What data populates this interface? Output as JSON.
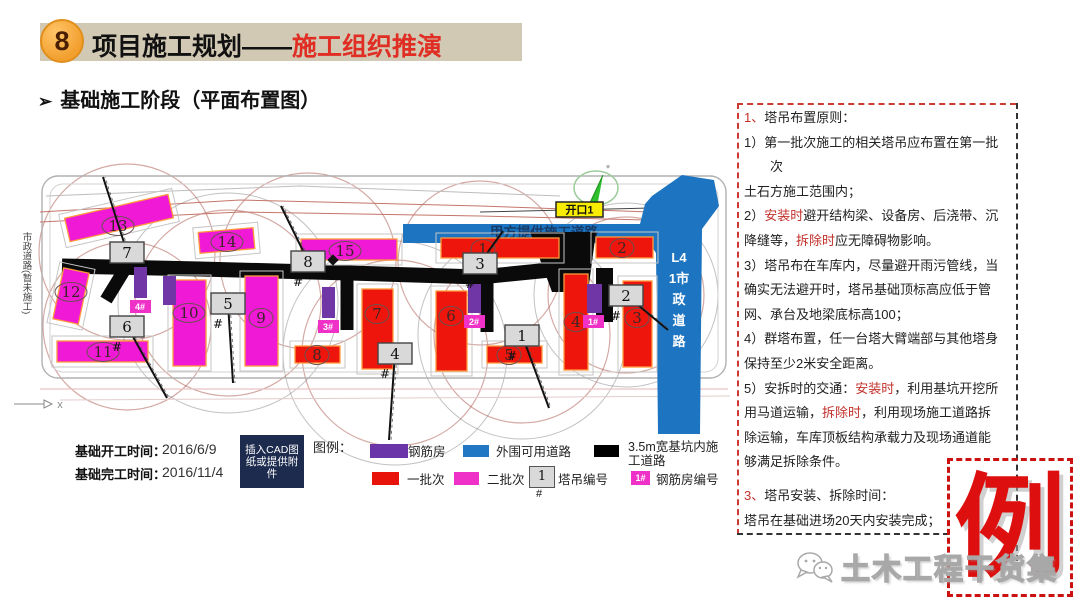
{
  "header": {
    "number": "8",
    "title_black": "项目施工规划——",
    "title_red": "施工组织推演"
  },
  "subtitle": {
    "bullet": "➢",
    "text": "基础施工阶段（平面布置图）"
  },
  "panel": {
    "lines": [
      {
        "seg": [
          {
            "t": "1、",
            "red": true
          },
          {
            "t": "塔吊布置原则：",
            "red": false
          }
        ]
      },
      {
        "seg": [
          {
            "t": "1）第一批次施工的相关塔吊应布置在第一批",
            "red": false
          }
        ]
      },
      {
        "seg": [
          {
            "t": "　　次",
            "red": false
          }
        ]
      },
      {
        "seg": [
          {
            "t": "土石方施工范围内；",
            "red": false
          }
        ]
      },
      {
        "seg": [
          {
            "t": "2）",
            "red": false
          },
          {
            "t": "安装时",
            "red": true
          },
          {
            "t": "避开结构梁、设备房、后浇带、沉",
            "red": false
          }
        ]
      },
      {
        "seg": [
          {
            "t": "降缝等，",
            "red": false
          },
          {
            "t": "拆除时",
            "red": true
          },
          {
            "t": "应无障碍物影响。",
            "red": false
          }
        ]
      },
      {
        "seg": [
          {
            "t": "3）塔吊布在车库内，尽量避开雨污管线，当",
            "red": false
          }
        ]
      },
      {
        "seg": [
          {
            "t": "确实无法避开时，塔吊基础顶标高应低于管",
            "red": false
          }
        ]
      },
      {
        "seg": [
          {
            "t": "网、承台及地梁底标高100；",
            "red": false
          }
        ]
      },
      {
        "seg": [
          {
            "t": "4）群塔布置，任一台塔大臂端部与其他塔身",
            "red": false
          }
        ]
      },
      {
        "seg": [
          {
            "t": "保持至少2米安全距离。",
            "red": false
          }
        ]
      },
      {
        "seg": [
          {
            "t": "5）安拆时的交通：",
            "red": false
          },
          {
            "t": "安装时",
            "red": true
          },
          {
            "t": "，利用基坑开挖所",
            "red": false
          }
        ]
      },
      {
        "seg": [
          {
            "t": "用马道运输，",
            "red": false
          },
          {
            "t": "拆除时",
            "red": true
          },
          {
            "t": "，利用现场施工道路拆",
            "red": false
          }
        ]
      },
      {
        "seg": [
          {
            "t": "除运输，车库顶板结构承载力及现场通道能",
            "red": false
          }
        ]
      },
      {
        "seg": [
          {
            "t": "够满足拆除条件。",
            "red": false
          }
        ]
      },
      {
        "gap": true,
        "seg": [
          {
            "t": "3、",
            "red": true
          },
          {
            "t": "塔吊安装、拆除时间：",
            "red": false
          }
        ]
      },
      {
        "seg": [
          {
            "t": "塔吊在基础进场20天内安装完成；",
            "red": false
          }
        ]
      }
    ]
  },
  "stamp": "例",
  "watermark": "土木工程干货集",
  "dates": {
    "start_label": "基础开工时间：",
    "start_value": "2016/6/9",
    "end_label": "基础完工时间：",
    "end_value": "2016/11/4"
  },
  "legend": {
    "title": "图例：",
    "cad_box": "插入CAD图纸或提供附件",
    "items_row1": [
      {
        "color": "#6a35a8",
        "label": "钢筋房"
      },
      {
        "color": "#2277c4",
        "label": "外围可用道路"
      },
      {
        "color": "#000000",
        "label": "3.5m宽基坑内施工道路"
      }
    ],
    "items_row2": [
      {
        "color": "#e8140c",
        "label": "一批次"
      },
      {
        "color": "#f031c8",
        "label": "二批次"
      }
    ],
    "crane_key": {
      "num": "1",
      "hash": "#",
      "label": "塔吊编号"
    },
    "rebar_key": {
      "num": "1#",
      "label": "钢筋房编号"
    }
  },
  "plan": {
    "side_road_label": "市政道路(暂未施工)",
    "axis_label": "x",
    "opening_label": "开口1",
    "top_road_label": "甲方提供施工道路",
    "right_road_chars": [
      "L4",
      "1市",
      "政",
      "道",
      "路"
    ],
    "colors": {
      "red": "#ee150c",
      "magenta": "#f019d6",
      "purple": "#7136a6",
      "blue": "#1d74c0",
      "road": "#0a0a0a",
      "crane_box": "#d9d9d9"
    },
    "buildings": [
      {
        "batch": "red",
        "n": "1",
        "x": 441,
        "y": 238,
        "w": 118,
        "h": 20,
        "cx": 483,
        "cy": 249
      },
      {
        "batch": "red",
        "n": "2",
        "x": 596,
        "y": 237,
        "w": 57,
        "h": 21,
        "cx": 622,
        "cy": 248
      },
      {
        "batch": "red",
        "n": "7",
        "x": 362,
        "y": 289,
        "w": 31,
        "h": 80,
        "cx": 377,
        "cy": 314
      },
      {
        "batch": "red",
        "n": "6",
        "x": 436,
        "y": 291,
        "w": 31,
        "h": 80,
        "cx": 451,
        "cy": 316
      },
      {
        "batch": "red",
        "n": "4",
        "x": 564,
        "y": 274,
        "w": 24,
        "h": 96,
        "cx": 576,
        "cy": 322
      },
      {
        "batch": "red",
        "n": "3",
        "x": 623,
        "y": 281,
        "w": 29,
        "h": 86,
        "cx": 637,
        "cy": 318
      },
      {
        "batch": "red",
        "n": "8",
        "x": 295,
        "y": 346,
        "w": 45,
        "h": 17,
        "cx": 317,
        "cy": 355
      },
      {
        "batch": "red",
        "n": "5",
        "x": 487,
        "y": 346,
        "w": 55,
        "h": 17,
        "cx": 509,
        "cy": 355
      },
      {
        "batch": "magenta",
        "n": "13",
        "x": 66,
        "y": 206,
        "w": 106,
        "h": 24,
        "rot": -13,
        "cx": 118,
        "cy": 226
      },
      {
        "batch": "magenta",
        "n": "14",
        "x": 199,
        "y": 230,
        "w": 55,
        "h": 21,
        "rot": -5,
        "cx": 227,
        "cy": 242
      },
      {
        "batch": "magenta",
        "n": "15",
        "x": 301,
        "y": 239,
        "w": 96,
        "h": 21,
        "cx": 345,
        "cy": 251
      },
      {
        "batch": "magenta",
        "n": "12",
        "x": 58,
        "y": 270,
        "w": 26,
        "h": 52,
        "rot": 12,
        "cx": 71,
        "cy": 292
      },
      {
        "batch": "magenta",
        "n": "11",
        "x": 57,
        "y": 341,
        "w": 91,
        "h": 21,
        "cx": 103,
        "cy": 352
      },
      {
        "batch": "magenta",
        "n": "10",
        "x": 173,
        "y": 280,
        "w": 33,
        "h": 86,
        "cx": 189,
        "cy": 313
      },
      {
        "batch": "magenta",
        "n": "9",
        "x": 245,
        "y": 276,
        "w": 33,
        "h": 90,
        "cx": 261,
        "cy": 318
      }
    ],
    "rebar_houses": [
      {
        "x": 134,
        "y": 267,
        "w": 13,
        "h": 31,
        "label": "4#"
      },
      {
        "x": 163,
        "y": 276,
        "w": 13,
        "h": 29
      },
      {
        "x": 322,
        "y": 287,
        "w": 13,
        "h": 31,
        "label": "3#"
      },
      {
        "x": 468,
        "y": 284,
        "w": 13,
        "h": 29,
        "label": "2#"
      },
      {
        "x": 587,
        "y": 284,
        "w": 15,
        "h": 29,
        "label": "1#"
      }
    ],
    "cranes": [
      {
        "n": "7",
        "x": 110,
        "y": 242,
        "r": 88,
        "boom": [
          103,
          177
        ],
        "hash": false
      },
      {
        "n": "8",
        "x": 291,
        "y": 251,
        "r": 88,
        "boom": [
          281,
          206
        ],
        "hash": true
      },
      {
        "n": "3",
        "x": 463,
        "y": 253,
        "r": 82,
        "boom": [
          503,
          231
        ],
        "hash": true
      },
      {
        "n": "2",
        "x": 609,
        "y": 285,
        "r": 78,
        "boom": [
          668,
          330
        ],
        "hash": true
      },
      {
        "n": "5",
        "x": 211,
        "y": 293,
        "r": 93,
        "boom": [
          233,
          383
        ],
        "hash": true
      },
      {
        "n": "6",
        "x": 110,
        "y": 316,
        "r": 84,
        "boom": [
          167,
          398
        ],
        "hash": true
      },
      {
        "n": "4",
        "x": 378,
        "y": 343,
        "r": 93,
        "boom": [
          389,
          440
        ],
        "hash": true
      },
      {
        "n": "1",
        "x": 505,
        "y": 325,
        "r": 88,
        "boom": [
          549,
          408
        ],
        "hash": true
      }
    ]
  }
}
